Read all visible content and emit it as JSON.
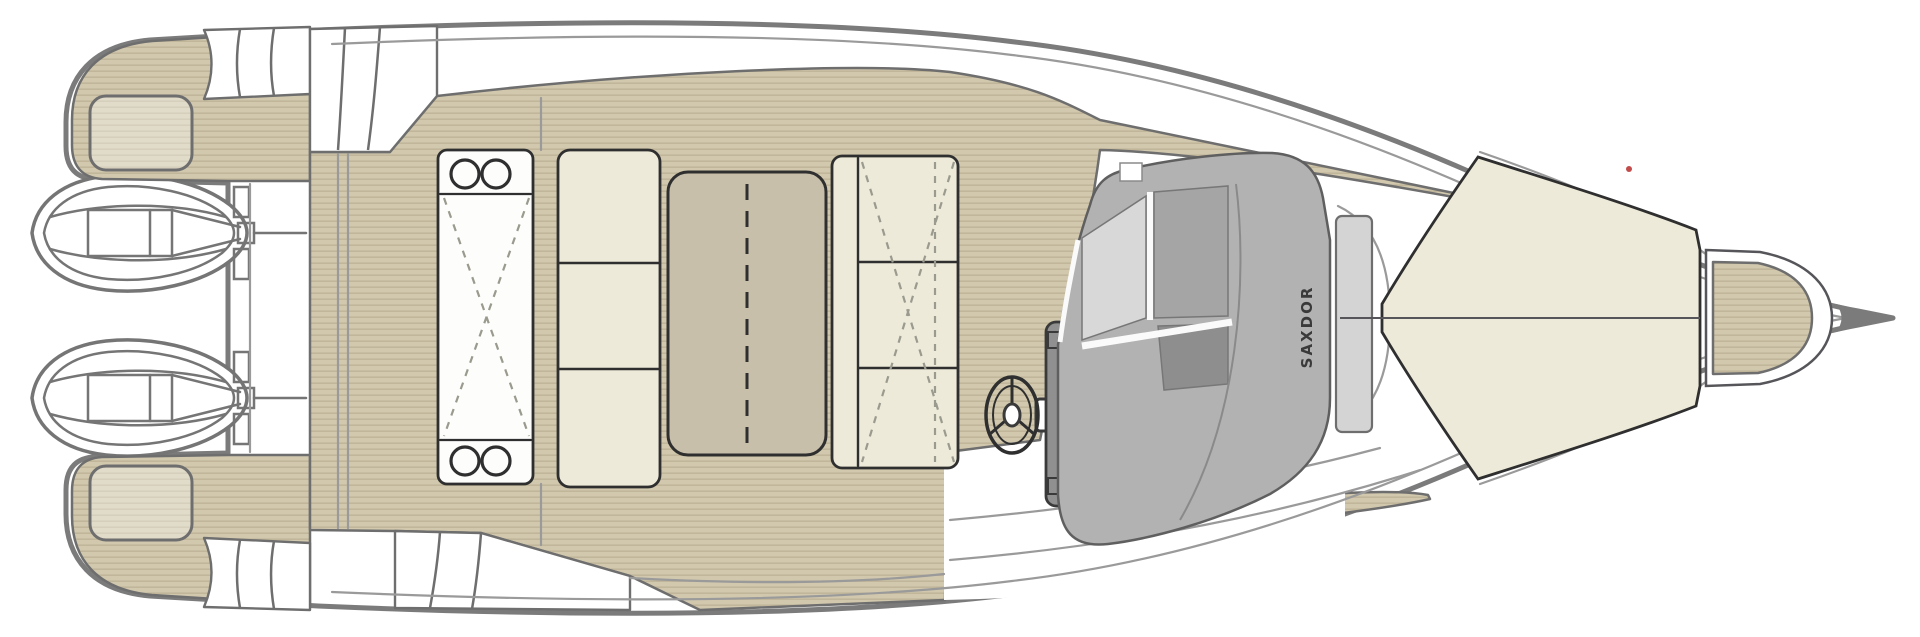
{
  "diagram": {
    "type": "boat-deck-plan",
    "view": "top-down layout drawing",
    "brand_label": "SAXDOR",
    "engines": {
      "count": 2,
      "type": "outboard"
    },
    "colors": {
      "background": "#ffffff",
      "hull-line": "#7b7b7b",
      "inner-line": "#9a9a9a",
      "furniture-line": "#3a3a3a",
      "teak": "#d1c8ae",
      "teak-stripe": "#c1b699",
      "teak-edge": "#6e6e6e",
      "upholstery": "#edead9",
      "upholstery-line": "#2f2f2f",
      "table-top": "#c8bfab",
      "console-base": "#b2b2b2",
      "glass-light": "#d8d8d8",
      "glass-mid": "#a5a5a5",
      "glass-dark": "#8e8e8e",
      "pod-gray": "#909090",
      "step-light": "#d4d4d4",
      "brand-text": "#3a3a3a",
      "marker-red": "#c24b4b",
      "dash-line": "#9a9a8e"
    },
    "parts": [
      {
        "id": "hull",
        "label": "Hull"
      },
      {
        "id": "port-engine",
        "label": "Outboard engine (upper)"
      },
      {
        "id": "starboard-engine",
        "label": "Outboard engine (lower)"
      },
      {
        "id": "transom",
        "label": "Transom"
      },
      {
        "id": "aft-platform-upper",
        "label": "Aft swim platform (upper quarter)"
      },
      {
        "id": "aft-platform-lower",
        "label": "Aft swim platform (lower quarter)"
      },
      {
        "id": "cockpit-deck",
        "label": "Teak cockpit deck"
      },
      {
        "id": "aft-galley-module",
        "label": "Aft module with cupholders"
      },
      {
        "id": "aft-bench",
        "label": "Aft bench seat"
      },
      {
        "id": "cockpit-table",
        "label": "Cockpit table"
      },
      {
        "id": "forward-bench",
        "label": "Forward-facing bench seat"
      },
      {
        "id": "steering-wheel",
        "label": "Steering wheel"
      },
      {
        "id": "helm-pod",
        "label": "Helm instrument pod"
      },
      {
        "id": "helm-console",
        "label": "Helm console with windshield"
      },
      {
        "id": "windshield-front-pane",
        "label": "Windshield front pane"
      },
      {
        "id": "side-deck-upper",
        "label": "Teak side deck (upper)"
      },
      {
        "id": "side-deck-lower",
        "label": "Teak side deck (lower)"
      },
      {
        "id": "bow-sunpad",
        "label": "Bow sun pad"
      },
      {
        "id": "anchor-hatch",
        "label": "Teak anchor locker hatch"
      },
      {
        "id": "bow-roller",
        "label": "Bow roller"
      }
    ]
  }
}
